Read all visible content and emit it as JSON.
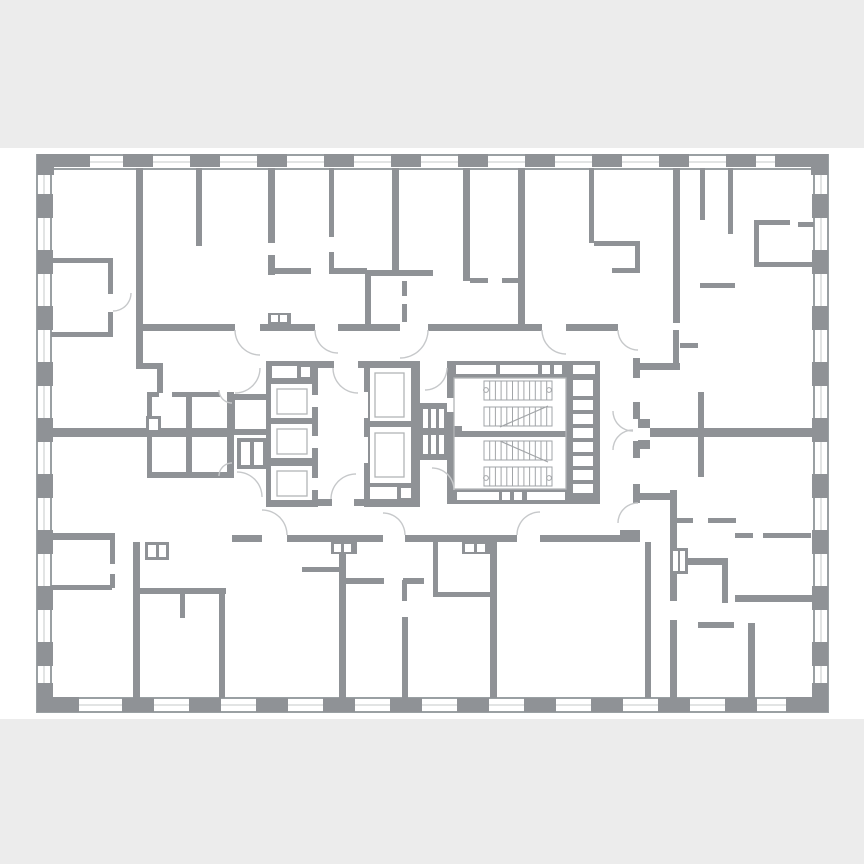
{
  "canvas": {
    "w": 864,
    "h": 864
  },
  "colors": {
    "band": "#ececec",
    "paper": "#ffffff",
    "wall": "#8f9296",
    "window_edge": "#9aa0a3",
    "window_mid": "#c6c8ca",
    "inner_stroke": "#b2b5b7",
    "tread": "#a2a5a8",
    "arc": "#c6c8ca"
  },
  "bands": {
    "top": {
      "y": 0,
      "h": 148
    },
    "bottom": {
      "y": 719,
      "h": 145
    }
  },
  "outer": {
    "x": 37,
    "y": 155,
    "w": 791,
    "h": 557,
    "band": 14
  },
  "corners": [
    [
      37,
      154,
      53,
      13
    ],
    [
      37,
      154,
      17,
      21
    ],
    [
      775,
      154,
      53,
      13
    ],
    [
      811,
      154,
      17,
      21
    ],
    [
      37,
      697,
      42,
      15
    ],
    [
      37,
      683,
      16,
      29
    ],
    [
      786,
      697,
      42,
      15
    ],
    [
      812,
      683,
      16,
      29
    ]
  ],
  "columns": {
    "top": {
      "y": 154,
      "h": 13,
      "w": 30,
      "centers": [
        138,
        205,
        272,
        339,
        406,
        473,
        540,
        607,
        674,
        741
      ]
    },
    "bottom": {
      "y": 698,
      "h": 14,
      "w": 32,
      "centers": [
        138,
        205,
        272,
        339,
        406,
        473,
        540,
        607,
        674,
        741
      ]
    },
    "left": {
      "x": 37,
      "w": 16,
      "h": 24,
      "centers": [
        206,
        262,
        318,
        374,
        430,
        486,
        542,
        598,
        654
      ]
    },
    "right": {
      "x": 812,
      "w": 16,
      "h": 24,
      "centers": [
        206,
        262,
        318,
        374,
        430,
        486,
        542,
        598,
        654
      ]
    }
  },
  "walls": [
    [
      136,
      168,
      7,
      197
    ],
    [
      196,
      168,
      6,
      78
    ],
    [
      268,
      168,
      7,
      75
    ],
    [
      268,
      255,
      7,
      20
    ],
    [
      329,
      168,
      5,
      69
    ],
    [
      329,
      252,
      5,
      21
    ],
    [
      270,
      268,
      41,
      6
    ],
    [
      329,
      268,
      38,
      6
    ],
    [
      392,
      168,
      7,
      102
    ],
    [
      365,
      270,
      68,
      6
    ],
    [
      365,
      276,
      6,
      51
    ],
    [
      402,
      281,
      5,
      15
    ],
    [
      402,
      304,
      5,
      18
    ],
    [
      463,
      168,
      7,
      113
    ],
    [
      470,
      278,
      18,
      5
    ],
    [
      502,
      278,
      18,
      5
    ],
    [
      518,
      168,
      7,
      162
    ],
    [
      589,
      168,
      5,
      75
    ],
    [
      594,
      241,
      46,
      5
    ],
    [
      635,
      241,
      5,
      30
    ],
    [
      612,
      268,
      28,
      5
    ],
    [
      673,
      168,
      7,
      155
    ],
    [
      700,
      168,
      5,
      52
    ],
    [
      700,
      283,
      35,
      5
    ],
    [
      728,
      168,
      5,
      66
    ],
    [
      754,
      220,
      36,
      5
    ],
    [
      754,
      225,
      5,
      42
    ],
    [
      757,
      262,
      57,
      5
    ],
    [
      798,
      222,
      16,
      5
    ],
    [
      140,
      324,
      95,
      7
    ],
    [
      260,
      324,
      55,
      7
    ],
    [
      338,
      324,
      62,
      7
    ],
    [
      428,
      324,
      114,
      7
    ],
    [
      566,
      324,
      52,
      7
    ],
    [
      51,
      258,
      62,
      5
    ],
    [
      108,
      258,
      5,
      36
    ],
    [
      108,
      312,
      5,
      25
    ],
    [
      51,
      332,
      62,
      5
    ],
    [
      51,
      533,
      64,
      7
    ],
    [
      110,
      533,
      5,
      31
    ],
    [
      51,
      585,
      61,
      5
    ],
    [
      110,
      574,
      5,
      14
    ],
    [
      136,
      363,
      27,
      6
    ],
    [
      157,
      363,
      6,
      30
    ],
    [
      147,
      392,
      12,
      5
    ],
    [
      172,
      392,
      48,
      5
    ],
    [
      147,
      392,
      5,
      86
    ],
    [
      186,
      397,
      6,
      81
    ],
    [
      146,
      416,
      15,
      17
    ],
    [
      51,
      428,
      182,
      9
    ],
    [
      147,
      472,
      86,
      6
    ],
    [
      227,
      392,
      7,
      86
    ],
    [
      229,
      394,
      40,
      6
    ],
    [
      229,
      394,
      6,
      41
    ],
    [
      229,
      429,
      40,
      6
    ],
    [
      237,
      438,
      32,
      31
    ],
    [
      312,
      361,
      22,
      7
    ],
    [
      358,
      361,
      8,
      7
    ],
    [
      312,
      499,
      20,
      7
    ],
    [
      354,
      499,
      12,
      7
    ],
    [
      266,
      361,
      52,
      146
    ],
    [
      364,
      361,
      56,
      146
    ],
    [
      418,
      403,
      34,
      57
    ],
    [
      452,
      426,
      10,
      7
    ],
    [
      447,
      361,
      153,
      17
    ],
    [
      447,
      489,
      153,
      15
    ],
    [
      447,
      361,
      7,
      142
    ],
    [
      593,
      361,
      7,
      142
    ],
    [
      566,
      378,
      34,
      112
    ],
    [
      447,
      431,
      123,
      6
    ],
    [
      232,
      535,
      30,
      7
    ],
    [
      287,
      535,
      96,
      7
    ],
    [
      405,
      535,
      112,
      7
    ],
    [
      540,
      535,
      100,
      7
    ],
    [
      620,
      530,
      20,
      7
    ],
    [
      633,
      358,
      7,
      20
    ],
    [
      633,
      402,
      7,
      17
    ],
    [
      633,
      441,
      7,
      17
    ],
    [
      633,
      484,
      7,
      19
    ],
    [
      638,
      419,
      12,
      9
    ],
    [
      638,
      440,
      12,
      9
    ],
    [
      650,
      428,
      164,
      9
    ],
    [
      698,
      392,
      6,
      85
    ],
    [
      640,
      363,
      40,
      7
    ],
    [
      673,
      330,
      6,
      40
    ],
    [
      680,
      343,
      18,
      5
    ],
    [
      133,
      542,
      7,
      156
    ],
    [
      145,
      542,
      24,
      18
    ],
    [
      138,
      588,
      88,
      6
    ],
    [
      219,
      594,
      6,
      104
    ],
    [
      180,
      594,
      5,
      24
    ],
    [
      339,
      542,
      7,
      156
    ],
    [
      331,
      542,
      26,
      12
    ],
    [
      302,
      567,
      37,
      5
    ],
    [
      346,
      578,
      38,
      6
    ],
    [
      402,
      617,
      6,
      81
    ],
    [
      402,
      580,
      5,
      21
    ],
    [
      403,
      578,
      21,
      6
    ],
    [
      433,
      542,
      5,
      55
    ],
    [
      433,
      592,
      60,
      5
    ],
    [
      462,
      542,
      29,
      12
    ],
    [
      490,
      542,
      7,
      156
    ],
    [
      645,
      542,
      6,
      156
    ],
    [
      670,
      490,
      7,
      111
    ],
    [
      670,
      548,
      18,
      26
    ],
    [
      677,
      558,
      51,
      7
    ],
    [
      722,
      565,
      6,
      38
    ],
    [
      735,
      595,
      78,
      7
    ],
    [
      677,
      518,
      16,
      5
    ],
    [
      708,
      518,
      28,
      5
    ],
    [
      735,
      533,
      18,
      5
    ],
    [
      763,
      533,
      48,
      5
    ],
    [
      670,
      620,
      7,
      78
    ],
    [
      748,
      623,
      7,
      75
    ],
    [
      698,
      622,
      36,
      6
    ],
    [
      640,
      493,
      33,
      7
    ],
    [
      268,
      313,
      23,
      11
    ]
  ],
  "white_cells": [
    [
      272,
      366,
      25,
      12
    ],
    [
      301,
      367,
      9,
      10
    ],
    [
      271,
      384,
      41,
      34
    ],
    [
      271,
      424,
      41,
      34
    ],
    [
      271,
      466,
      41,
      34
    ],
    [
      309,
      395,
      9,
      12
    ],
    [
      309,
      436,
      9,
      12
    ],
    [
      309,
      478,
      9,
      12
    ],
    [
      370,
      368,
      41,
      53
    ],
    [
      370,
      427,
      41,
      56
    ],
    [
      370,
      487,
      27,
      12
    ],
    [
      401,
      488,
      10,
      10
    ],
    [
      364,
      392,
      4,
      26
    ],
    [
      364,
      437,
      4,
      26
    ],
    [
      423,
      409,
      5,
      19
    ],
    [
      431,
      409,
      5,
      19
    ],
    [
      439,
      409,
      5,
      19
    ],
    [
      423,
      435,
      5,
      19
    ],
    [
      431,
      435,
      5,
      19
    ],
    [
      439,
      435,
      5,
      19
    ],
    [
      456,
      365,
      40,
      9
    ],
    [
      500,
      365,
      38,
      9
    ],
    [
      542,
      365,
      8,
      9
    ],
    [
      554,
      365,
      8,
      9
    ],
    [
      573,
      365,
      22,
      9
    ],
    [
      457,
      492,
      42,
      8
    ],
    [
      502,
      492,
      8,
      8
    ],
    [
      514,
      492,
      8,
      8
    ],
    [
      527,
      492,
      38,
      8
    ],
    [
      573,
      380,
      20,
      16
    ],
    [
      573,
      400,
      20,
      10
    ],
    [
      573,
      414,
      20,
      10
    ],
    [
      573,
      428,
      20,
      10
    ],
    [
      573,
      442,
      20,
      10
    ],
    [
      573,
      456,
      20,
      10
    ],
    [
      573,
      470,
      20,
      10
    ],
    [
      573,
      484,
      20,
      9
    ],
    [
      149,
      419,
      9,
      11
    ],
    [
      241,
      442,
      9,
      23
    ],
    [
      254,
      442,
      9,
      23
    ],
    [
      148,
      545,
      8,
      12
    ],
    [
      159,
      545,
      7,
      12
    ],
    [
      334,
      544,
      7,
      8
    ],
    [
      344,
      544,
      7,
      8
    ],
    [
      465,
      544,
      9,
      8
    ],
    [
      477,
      544,
      8,
      8
    ],
    [
      673,
      551,
      5,
      20
    ],
    [
      680,
      551,
      5,
      20
    ],
    [
      271,
      315,
      7,
      7
    ],
    [
      280,
      315,
      7,
      7
    ],
    [
      447,
      398,
      7,
      14
    ]
  ],
  "stroked_cells": [
    [
      277,
      389,
      30,
      25
    ],
    [
      277,
      429,
      30,
      25
    ],
    [
      277,
      471,
      30,
      25
    ],
    [
      375,
      373,
      29,
      44
    ],
    [
      375,
      433,
      29,
      44
    ],
    [
      454,
      378,
      112,
      111
    ]
  ],
  "stair": {
    "x0": 484,
    "x1": 552,
    "step": 5.7,
    "runs": [
      [
        381,
        400
      ],
      [
        407,
        426
      ],
      [
        441,
        460
      ],
      [
        467,
        486
      ]
    ],
    "diagonals": [
      [
        500,
        427,
        548,
        406
      ],
      [
        500,
        441,
        548,
        462
      ]
    ],
    "circles": [
      [
        486,
        390
      ],
      [
        549,
        390
      ],
      [
        486,
        478
      ],
      [
        549,
        478
      ]
    ]
  },
  "arcs": [
    {
      "cx": 260,
      "cy": 330,
      "r": 25,
      "a0": 180,
      "a1": 90
    },
    {
      "cx": 338,
      "cy": 330,
      "r": 23,
      "a0": 180,
      "a1": 90
    },
    {
      "cx": 400,
      "cy": 330,
      "r": 28,
      "a0": 0,
      "a1": 90
    },
    {
      "cx": 566,
      "cy": 330,
      "r": 24,
      "a0": 180,
      "a1": 90
    },
    {
      "cx": 638,
      "cy": 330,
      "r": 20,
      "a0": 180,
      "a1": 90
    },
    {
      "cx": 262,
      "cy": 535,
      "r": 25,
      "a0": 0,
      "a1": -90
    },
    {
      "cx": 383,
      "cy": 535,
      "r": 22,
      "a0": 0,
      "a1": -90
    },
    {
      "cx": 540,
      "cy": 535,
      "r": 23,
      "a0": 180,
      "a1": 270
    },
    {
      "cx": 638,
      "cy": 523,
      "r": 20,
      "a0": 180,
      "a1": 270
    },
    {
      "cx": 358,
      "cy": 368,
      "r": 25,
      "a0": 180,
      "a1": 90
    },
    {
      "cx": 356,
      "cy": 499,
      "r": 25,
      "a0": 180,
      "a1": 270
    },
    {
      "cx": 235,
      "cy": 368,
      "r": 25,
      "a0": 0,
      "a1": 90
    },
    {
      "cx": 237,
      "cy": 497,
      "r": 25,
      "a0": 0,
      "a1": -90
    },
    {
      "cx": 425,
      "cy": 368,
      "r": 22,
      "a0": 0,
      "a1": 90
    },
    {
      "cx": 432,
      "cy": 490,
      "r": 22,
      "a0": 0,
      "a1": -90
    },
    {
      "cx": 633,
      "cy": 411,
      "r": 20,
      "a0": 180,
      "a1": 90
    },
    {
      "cx": 633,
      "cy": 450,
      "r": 20,
      "a0": 180,
      "a1": 270
    },
    {
      "cx": 113,
      "cy": 293,
      "r": 18,
      "a0": 0,
      "a1": 90
    },
    {
      "cx": 232,
      "cy": 390,
      "r": 13,
      "a0": 180,
      "a1": 90
    },
    {
      "cx": 232,
      "cy": 476,
      "r": 13,
      "a0": 180,
      "a1": 270
    }
  ]
}
